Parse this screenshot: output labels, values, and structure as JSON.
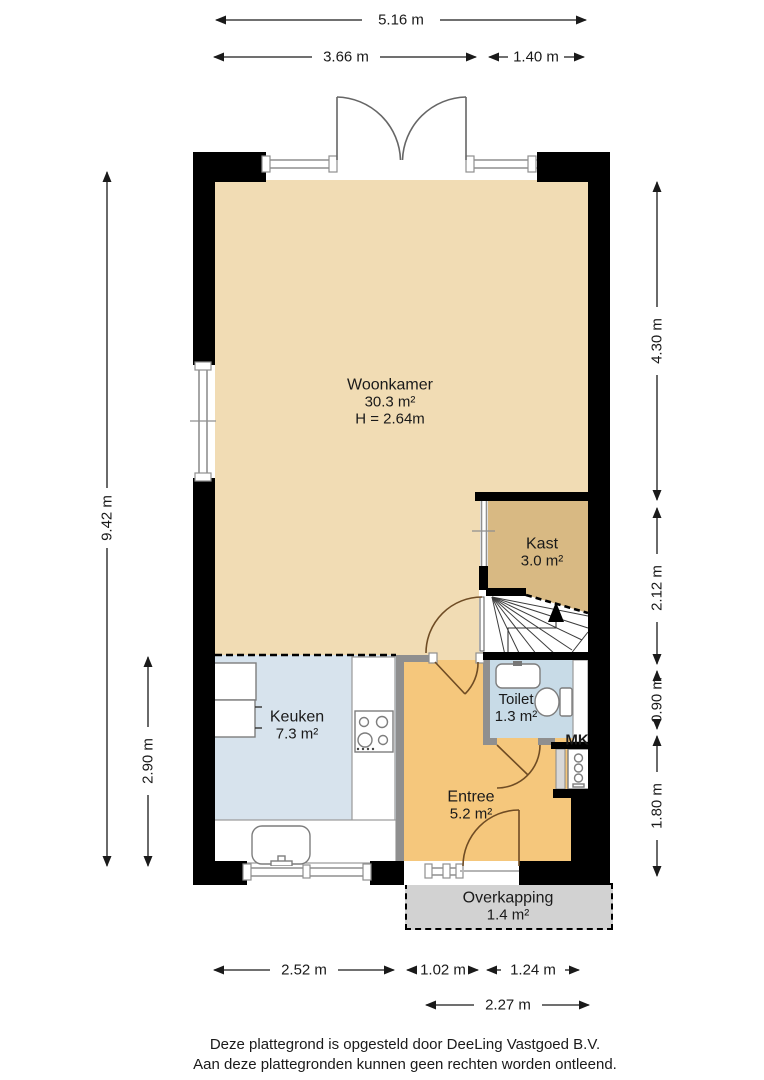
{
  "rooms": {
    "woonkamer": {
      "name": "Woonkamer",
      "area": "30.3 m²",
      "height": "H = 2.64m"
    },
    "kast": {
      "name": "Kast",
      "area": "3.0 m²"
    },
    "keuken": {
      "name": "Keuken",
      "area": "7.3 m²"
    },
    "toilet": {
      "name": "Toilet",
      "area": "1.3 m²"
    },
    "entree": {
      "name": "Entree",
      "area": "5.2 m²"
    },
    "overkapping": {
      "name": "Overkapping",
      "area": "1.4 m²"
    },
    "meterkast": {
      "name": "MK"
    }
  },
  "dimensions": {
    "top_total": "5.16 m",
    "top_left": "3.66 m",
    "top_right": "1.40 m",
    "left_total": "9.42 m",
    "left_lower": "2.90 m",
    "right_top": "4.30 m",
    "right_mid": "2.12 m",
    "right_toilet": "0.90 m",
    "right_bottom": "1.80 m",
    "bottom_keuken": "2.52 m",
    "bottom_door": "1.02 m",
    "bottom_right": "1.24 m",
    "bottom_total": "2.27 m"
  },
  "footer": {
    "line1": "Deze plattegrond is opgesteld door DeeLing Vastgoed B.V.",
    "line2": "Aan deze plattegronden kunnen geen rechten worden ontleend."
  },
  "colors": {
    "woonkamer": "#F1DCB4",
    "kast": "#D8B983",
    "keuken": "#D7E3ED",
    "toilet": "#C8DBE7",
    "entree": "#F5C77C",
    "overkapping": "#D2D2D2",
    "wall": "#000000",
    "window_frame": "#8F8F8F",
    "door_arc": "#6F4C24"
  }
}
